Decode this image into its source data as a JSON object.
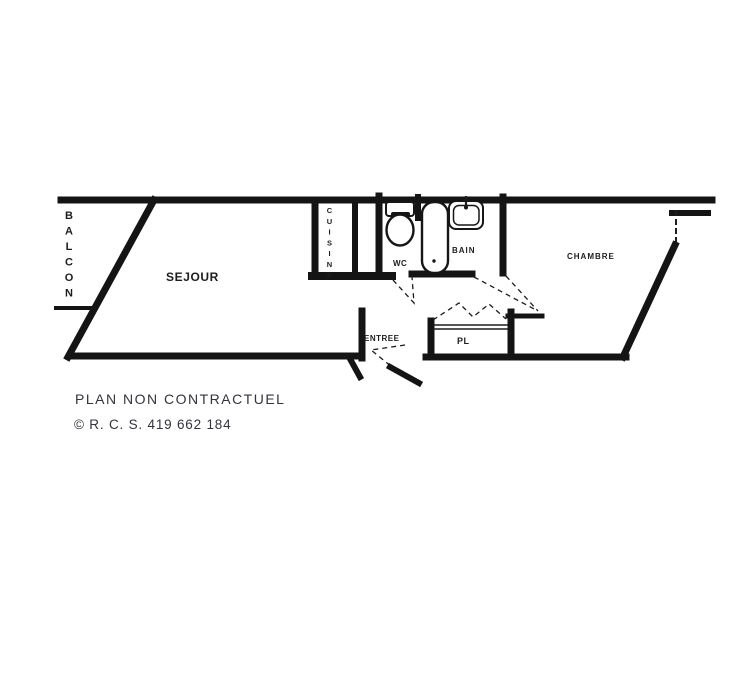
{
  "plan": {
    "rooms": {
      "balcon": "BALCON",
      "sejour": "SEJOUR",
      "cuisine": "CUISINE",
      "wc": "WC",
      "bain": "BAIN",
      "chambre": "CHAMBRE",
      "entree": "ENTREE",
      "pl": "PL"
    },
    "fixtures": [
      "toilet-icon",
      "bathtub-icon",
      "sink-icon"
    ],
    "doors": [
      "entry-door-swing",
      "wc-door-swing",
      "bain-door-swing",
      "chambre-door-swing",
      "pl-folding-door"
    ],
    "colors": {
      "background": "#ffffff",
      "wall": "#141414",
      "label": "#1d1d1d",
      "footer_text": "#34343c"
    }
  },
  "footer": {
    "disclaimer": "PLAN NON CONTRACTUEL",
    "rcs": "© R. C. S. 419 662 184"
  }
}
